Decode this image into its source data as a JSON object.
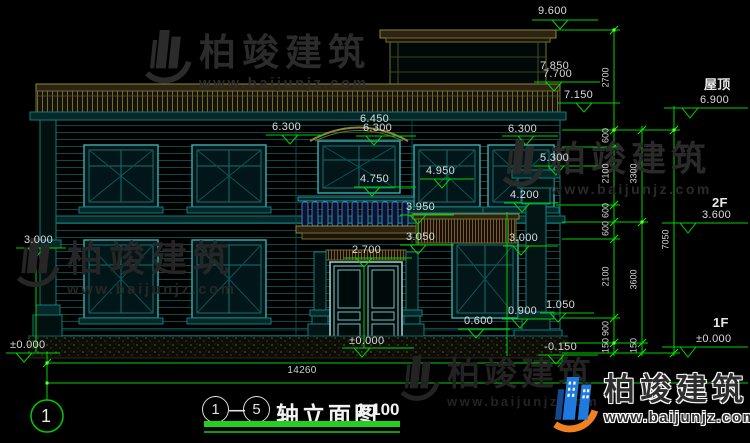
{
  "drawing": {
    "title": "轴立面图",
    "scale": "1:100",
    "axis_start": "1",
    "axis_end": "5",
    "axis_separator": "—",
    "bottom_axis_label": "1"
  },
  "levels": {
    "v9600": "9.600",
    "v7850": "7.850",
    "v7700": "7.700",
    "v7150": "7.150",
    "v6450": "6.450",
    "v6300_left": "6.300",
    "v6300_center": "6.300",
    "v6300_right": "6.300",
    "roof_label": "屋顶",
    "v6900": "6.900",
    "v5300": "5.300",
    "v4950": "4.950",
    "v4750": "4.750",
    "v4200": "4.200",
    "v3950": "3.950",
    "v3050": "3.050",
    "v3000_left": "3.000",
    "v3000_right": "3.000",
    "v2700": "2.700",
    "floor2_label": "2F",
    "v3600": "3.600",
    "floor1_label": "1F",
    "v0000_right": "±0.000",
    "v1050": "1.050",
    "v0900": "0.900",
    "v0600": "0.600",
    "v0000_door": "±0.000",
    "v0000_left": "±0.000",
    "vneg0150": "-0.150"
  },
  "dimensions": {
    "d2700": "2700",
    "d600_a": "600",
    "d2100_a": "2100",
    "d600_b": "600",
    "d600_c": "600",
    "d2100_b": "2100",
    "d900": "900",
    "d150_a": "150",
    "d3300": "3300",
    "d3600": "3600",
    "d150_b": "150",
    "d7050": "7050",
    "total_width": "14260"
  },
  "watermark": {
    "brand": "柏竣建筑",
    "url": "www.baijunjz.com"
  },
  "logo": {
    "brand": "柏竣建筑",
    "url": "www.baijunjz.com"
  }
}
